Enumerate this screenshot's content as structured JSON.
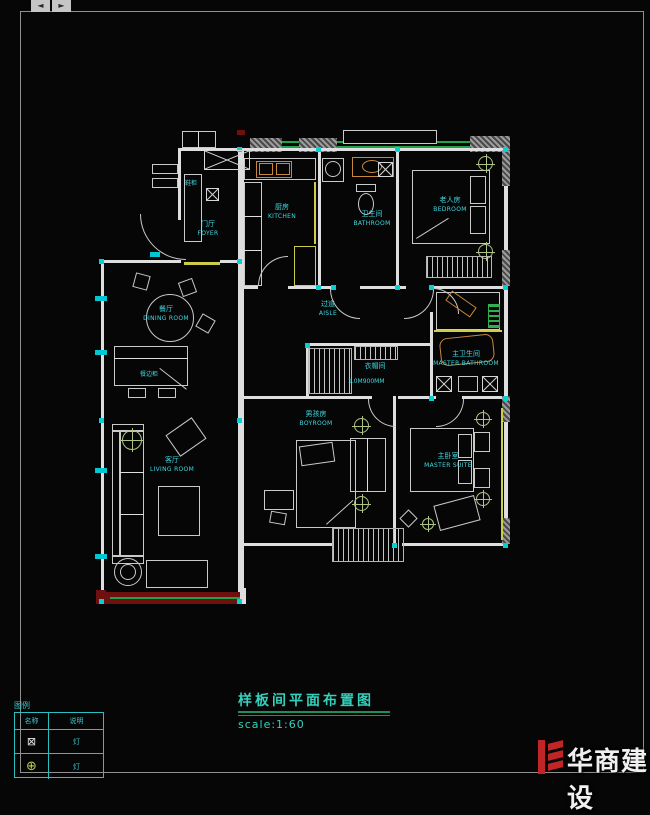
{
  "chrome": {
    "left_arrow": "◄",
    "right_arrow": "►"
  },
  "title_block": {
    "title": "样板间平面布置图",
    "scale": "scale:1:60"
  },
  "rooms": [
    {
      "id": "foyer",
      "cn": "门厅",
      "en": "FOYER"
    },
    {
      "id": "kitchen",
      "cn": "厨房",
      "en": "KITCHEN"
    },
    {
      "id": "bathroom",
      "cn": "卫生间",
      "en": "BATHROOM"
    },
    {
      "id": "bedroom",
      "cn": "老人房",
      "en": "BEDROOM"
    },
    {
      "id": "dining-room",
      "cn": "餐厅",
      "en": "DINING ROOM"
    },
    {
      "id": "aisle",
      "cn": "过道",
      "en": "AISLE"
    },
    {
      "id": "cloakroom",
      "cn": "衣帽间",
      "en": ""
    },
    {
      "id": "master-bathroom",
      "cn": "主卫生间",
      "en": "MASTER BATHROOM"
    },
    {
      "id": "boy-room",
      "cn": "男孩房",
      "en": "BOYROOM"
    },
    {
      "id": "living-room",
      "cn": "客厅",
      "en": "LIVING ROOM"
    },
    {
      "id": "master-suite",
      "cn": "主卧室",
      "en": "MASTER SUITE"
    }
  ],
  "annotations": {
    "foyer_cabinet": "鞋柜",
    "dining_cabinet": "餐边柜",
    "cloakroom_dim": "1.0M900MM"
  },
  "legend": {
    "title": "图例",
    "col1": "名称",
    "col2": "说明",
    "rows": [
      {
        "symbol": "⊠",
        "desc": "灯"
      },
      {
        "symbol": "⊕",
        "desc": "灯"
      }
    ]
  },
  "watermark": {
    "name": "华商建设"
  },
  "colors": {
    "wall": "#dedede",
    "label": "#41d8e2",
    "grip": "#00d2d2",
    "window_green": "#1fa34a",
    "cabinet_yellow": "#cdcd4a",
    "sill_red": "#6e1010",
    "fixture_tan": "#c8883c",
    "title_teal": "#35d0bc",
    "logo_red": "#c22525"
  }
}
